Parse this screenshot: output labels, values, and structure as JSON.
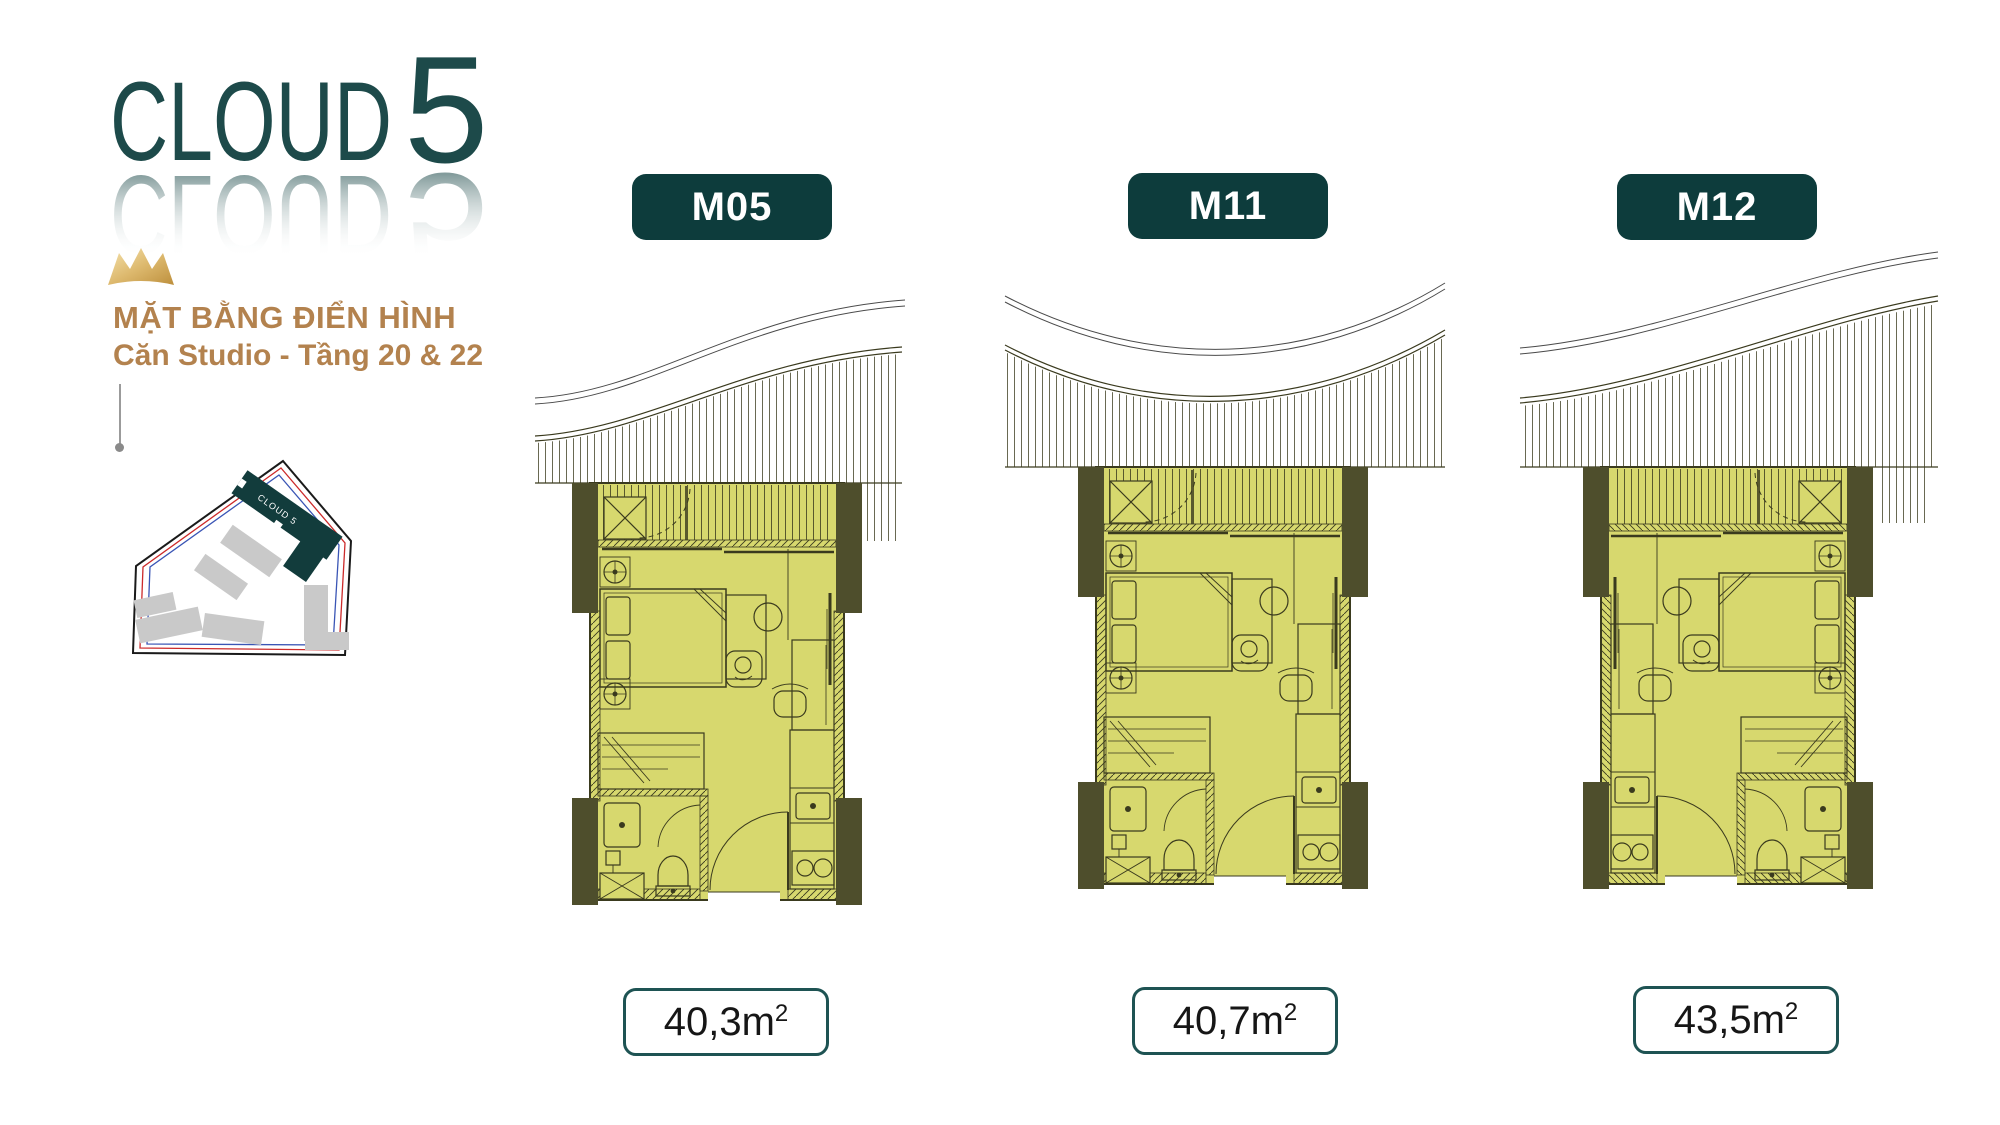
{
  "logo": {
    "text": "CLOUD",
    "number": "5"
  },
  "header": {
    "title": "MẶT BẰNG ĐIỂN HÌNH",
    "subtitle": "Căn Studio - Tầng 20 & 22"
  },
  "site_map": {
    "building_label": "CLOUD 5"
  },
  "plans": [
    {
      "code": "M05",
      "area_value": "40,3m",
      "area_sup": "2"
    },
    {
      "code": "M11",
      "area_value": "40,7m",
      "area_sup": "2"
    },
    {
      "code": "M12",
      "area_value": "43,5m",
      "area_sup": "2"
    }
  ],
  "colors": {
    "accent_teal": "#0d3c3c",
    "logo_teal": "#1d4a4a",
    "gold_text": "#b3824e",
    "plan_fill": "#d7d86e",
    "plan_line": "#3a3a1e",
    "column_fill": "#4e4e2c",
    "crown_gold": "#cf9f4a"
  }
}
